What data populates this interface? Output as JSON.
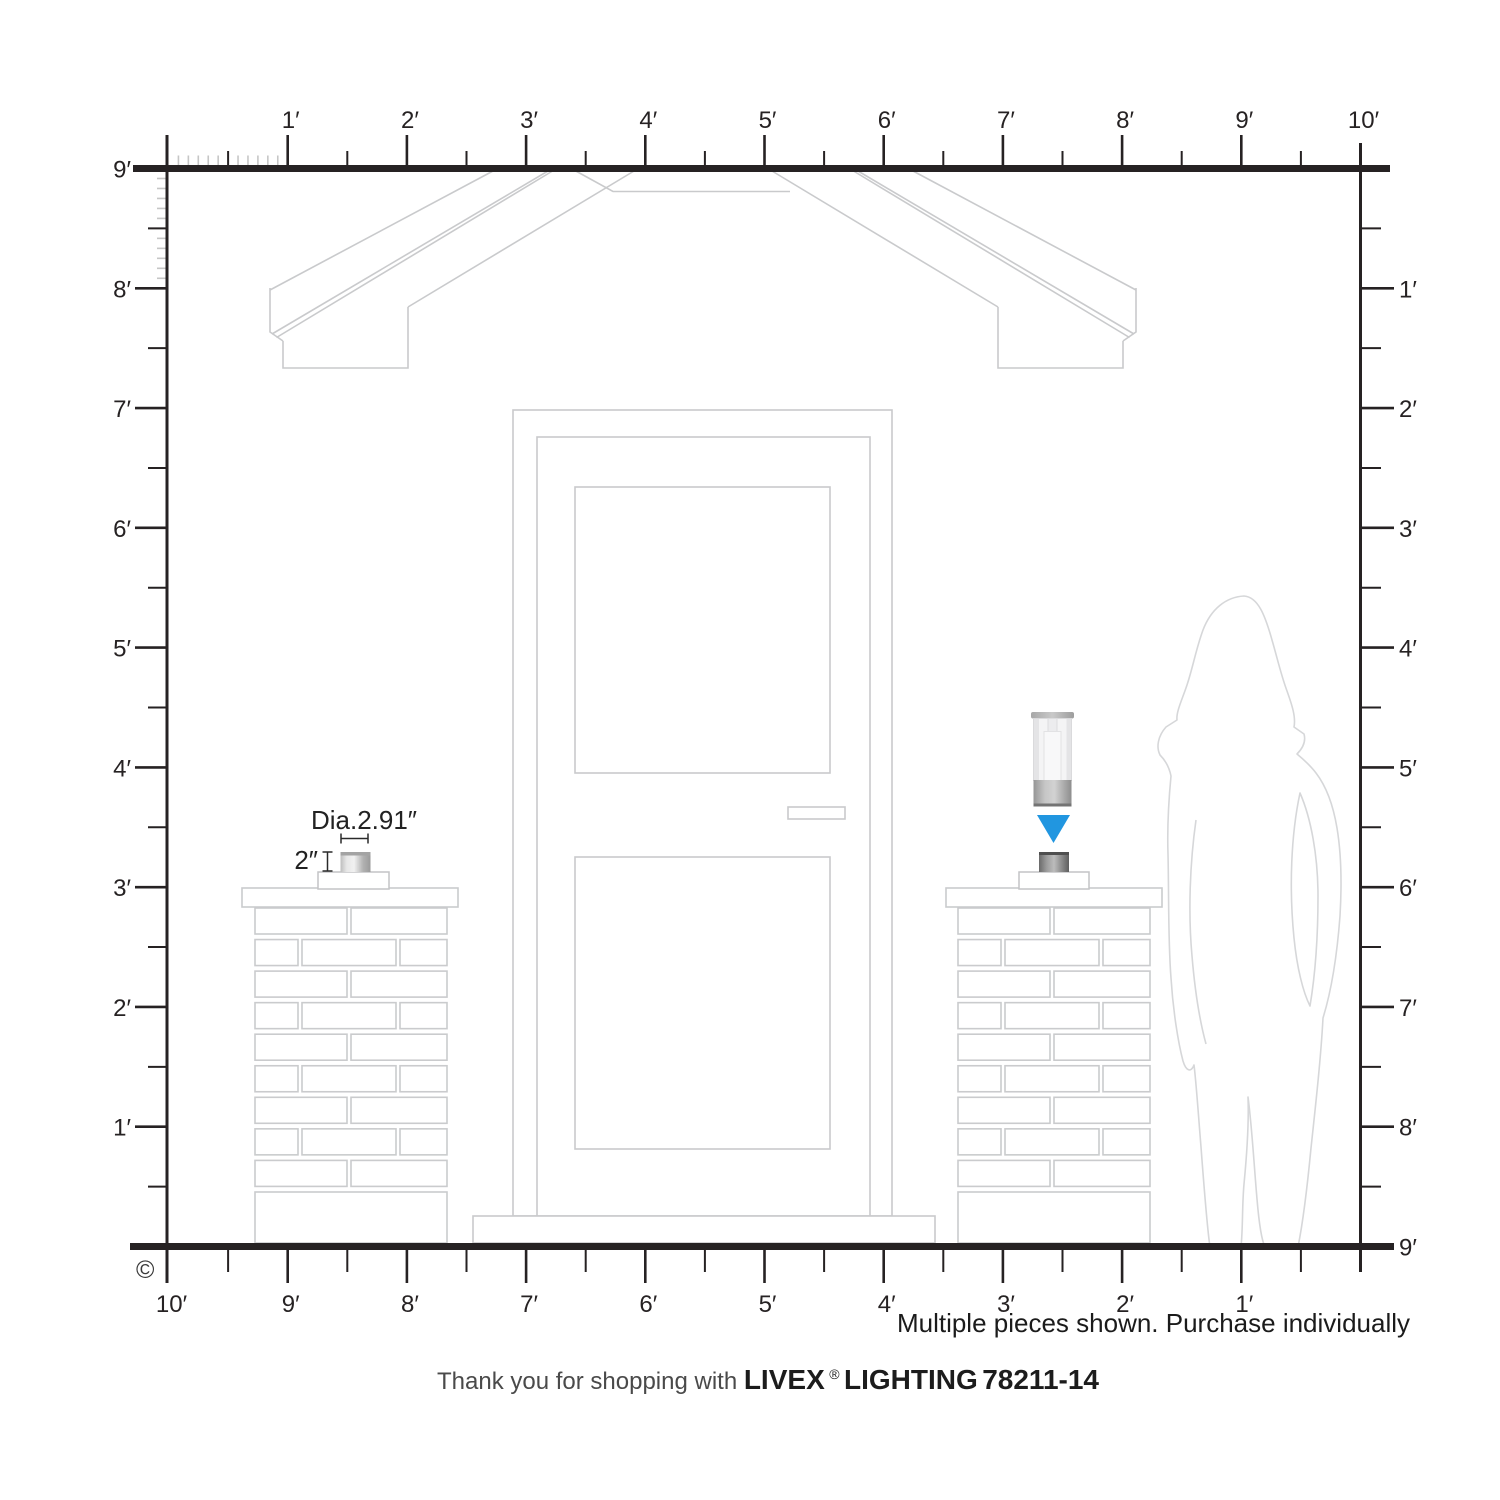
{
  "rulers": {
    "top": {
      "labels": [
        "1′",
        "2′",
        "3′",
        "4′",
        "5′",
        "6′",
        "7′",
        "8′",
        "9′",
        "10′"
      ]
    },
    "left": {
      "labels": [
        "9′",
        "8′",
        "7′",
        "6′",
        "5′",
        "4′",
        "3′",
        "2′",
        "1′"
      ]
    },
    "right": {
      "labels": [
        "1′",
        "2′",
        "3′",
        "4′",
        "5′",
        "6′",
        "7′",
        "8′",
        "9′"
      ]
    },
    "bottom": {
      "labels": [
        "10′",
        "9′",
        "8′",
        "7′",
        "6′",
        "5′",
        "4′",
        "3′",
        "2′",
        "1′"
      ]
    }
  },
  "annotations": {
    "diameter": "Dia.2.91″",
    "height": "2″"
  },
  "notes": {
    "purchase": "Multiple pieces shown. Purchase individually"
  },
  "footer": {
    "thanks": "Thank you for shopping with ",
    "brand": "LIVEX",
    "registered": "®",
    "brand_suffix": " LIGHTING",
    "sku": "  78211-14"
  },
  "copyright": "©",
  "colors": {
    "accent_blue": "#2196e0",
    "ruler": "#262223",
    "drawing_line": "#c9cacc",
    "silhouette_line": "#d6d7d9"
  },
  "icons": {
    "pointer": "down-triangle-pointer"
  }
}
